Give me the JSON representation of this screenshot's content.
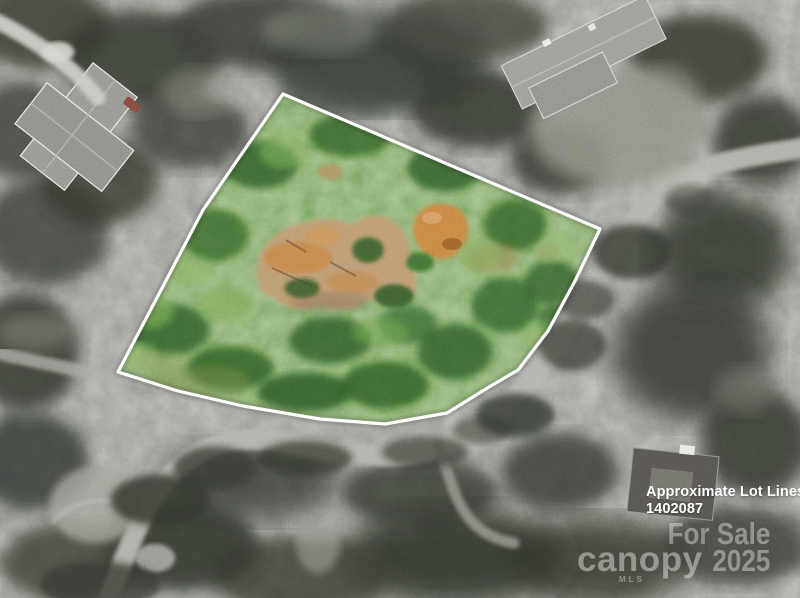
{
  "annotations": {
    "lot_label_line1": "Approximate Lot Lines",
    "lot_label_line2": "1402087"
  },
  "watermark": {
    "brand": "canopy",
    "brand_sub": "MLS",
    "line1": "For Sale",
    "line2": "2025"
  },
  "colors": {
    "boundary": "#ffffff",
    "road": "#aeaca5",
    "driveway": "#c7c5be",
    "dirt_tan": "#b6916c",
    "dirt_orange": "#c47c3e",
    "lot_green_dark": "#2d5424",
    "lot_green_light": "#6fa04b",
    "canopy_gray": "#3a3d36"
  }
}
